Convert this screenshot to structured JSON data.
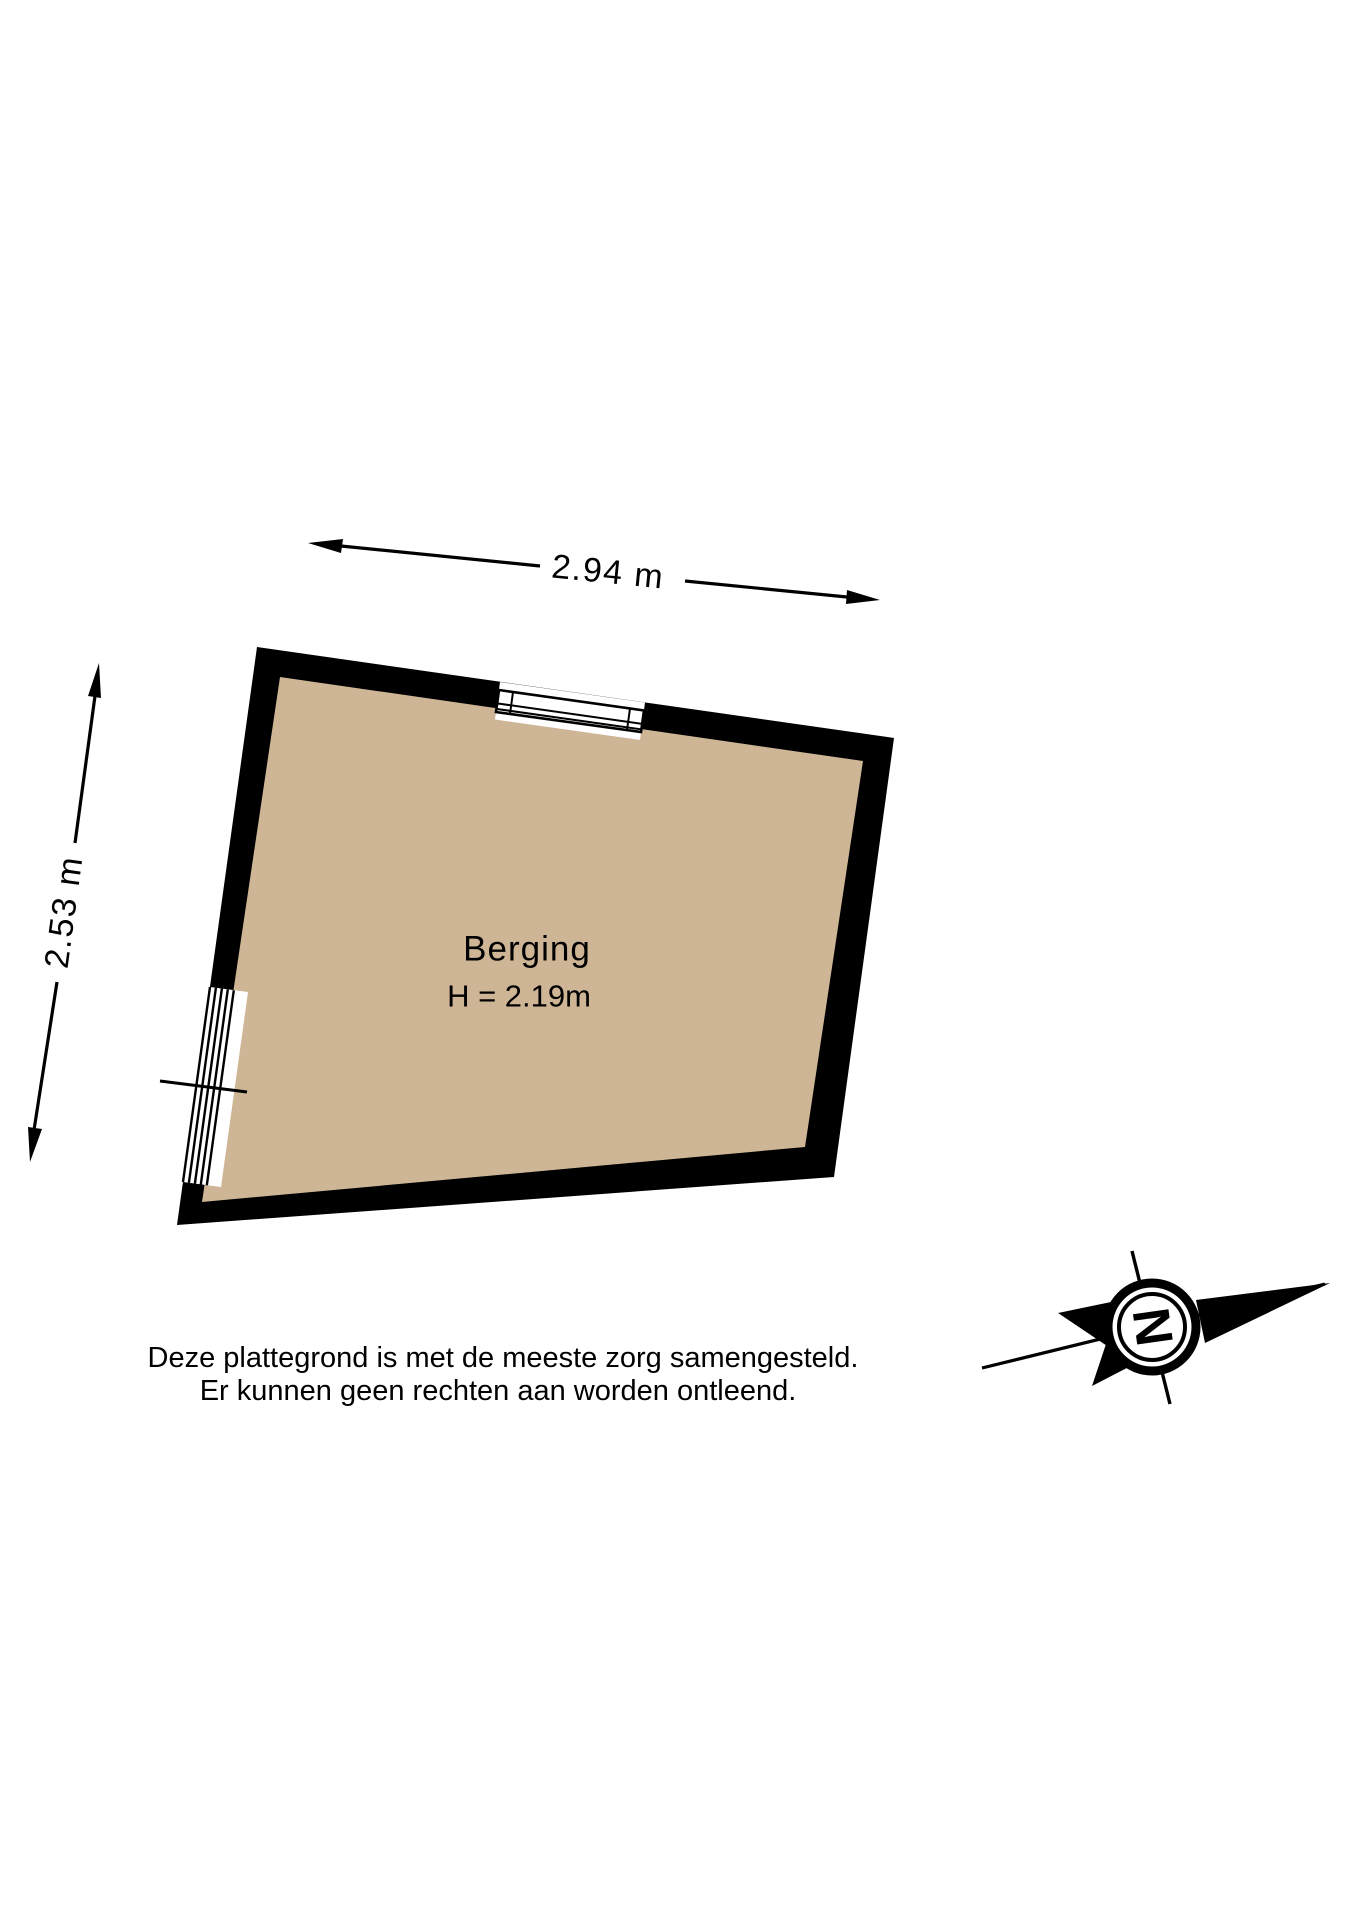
{
  "floorplan": {
    "room_label": "Berging",
    "room_height_label": "H = 2.19m",
    "width_dimension": "2.94 m",
    "height_dimension": "2.53 m"
  },
  "disclaimer": {
    "line1": "Deze plattegrond is met de meeste zorg samengesteld.",
    "line2": "Er kunnen geen rechten aan worden ontleend."
  },
  "compass": {
    "north_label": "N"
  },
  "colors": {
    "wall": "#000000",
    "floor": "#cdb596",
    "line": "#000000",
    "background": "#ffffff"
  }
}
